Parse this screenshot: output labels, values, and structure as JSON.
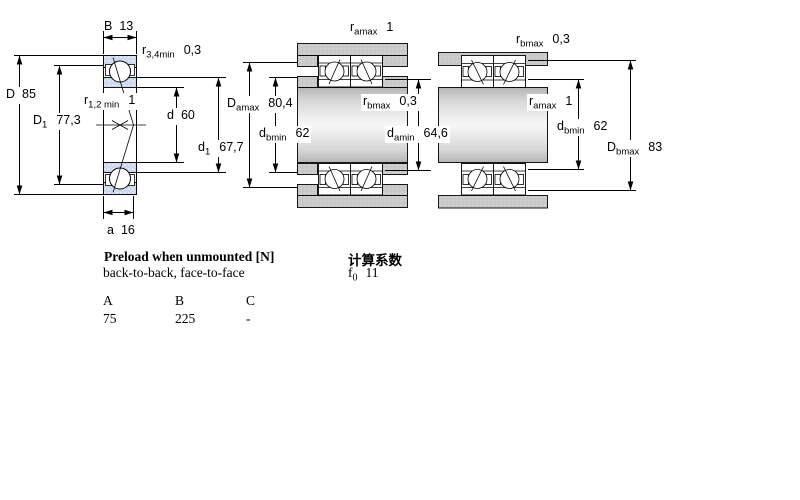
{
  "drawing": {
    "dims": {
      "B": {
        "pre": "B",
        "sub": "",
        "val": "13"
      },
      "r34": {
        "pre": "r",
        "sub": "3,4min",
        "val": "0,3"
      },
      "D": {
        "pre": "D",
        "sub": "",
        "val": "85"
      },
      "D1": {
        "pre": "D",
        "sub": "1",
        "val": "77,3"
      },
      "r12": {
        "pre": "r",
        "sub": "1,2 min",
        "val": "1"
      },
      "d": {
        "pre": "d",
        "sub": "",
        "val": "60"
      },
      "d1": {
        "pre": "d",
        "sub": "1",
        "val": "67,7"
      },
      "a": {
        "pre": "a",
        "sub": "",
        "val": "16"
      },
      "ramax_mid": {
        "pre": "r",
        "sub": "amax",
        "val": "1"
      },
      "Damax": {
        "pre": "D",
        "sub": "amax",
        "val": "80,4"
      },
      "dbmin_mid": {
        "pre": "d",
        "sub": "bmin",
        "val": "62"
      },
      "rbmax_mid": {
        "pre": "r",
        "sub": "bmax",
        "val": "0,3"
      },
      "damin": {
        "pre": "d",
        "sub": "amin",
        "val": "64,6"
      },
      "rbmax_right": {
        "pre": "r",
        "sub": "bmax",
        "val": "0,3"
      },
      "ramax_right": {
        "pre": "r",
        "sub": "amax",
        "val": "1"
      },
      "dbmin_right": {
        "pre": "d",
        "sub": "bmin",
        "val": "62"
      },
      "Dbmax": {
        "pre": "D",
        "sub": "bmax",
        "val": "83"
      }
    }
  },
  "preload": {
    "title": "Preload when unmounted [N]",
    "subtitle": "back-to-back, face-to-face",
    "columns": [
      "A",
      "B",
      "C"
    ],
    "values": [
      "75",
      "225",
      "-"
    ]
  },
  "calculation_factors": {
    "title": "计算系数",
    "f0": {
      "pre": "f",
      "sub": "0",
      "val": "11"
    }
  },
  "colors": {
    "bearing_section_fill": "#cbd6ec",
    "housing_fill": "#c9c9c9",
    "line": "#000000"
  }
}
